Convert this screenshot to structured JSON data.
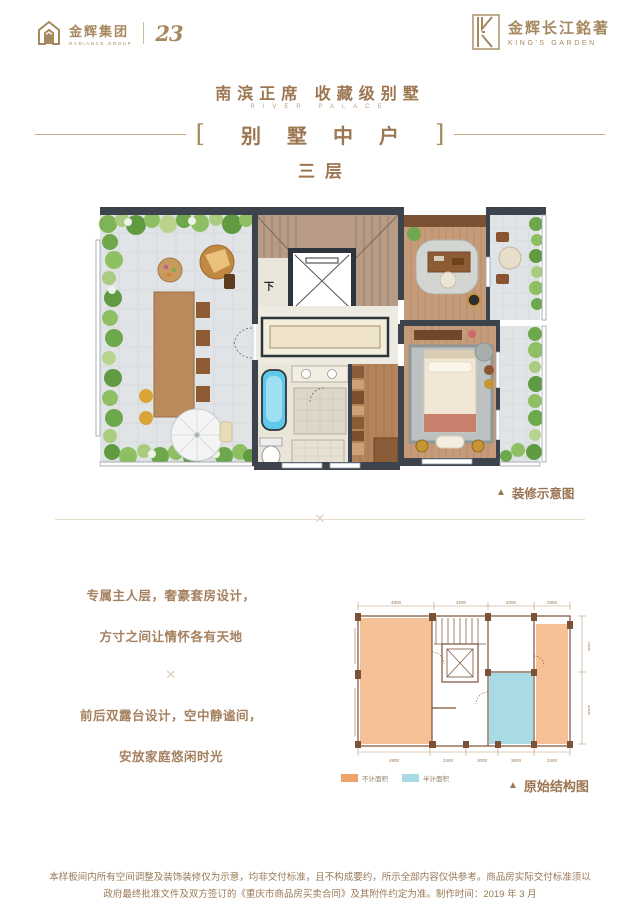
{
  "header": {
    "left_logo": {
      "name": "金辉集团",
      "tagline": "RADIANCE GROUP",
      "anniversary": "23"
    },
    "right_logo": {
      "name": "金辉长江銘著",
      "tagline": "KING'S GARDEN"
    },
    "title": "南滨正席 收藏级别墅",
    "title_en": "RIVER PALACE",
    "bracket_open": "[",
    "bracket_close": "]",
    "unit_label": "别墅中户",
    "floor_label": "三层"
  },
  "divider": {
    "ornament": "✕"
  },
  "plan": {
    "down_label": "下",
    "caption_marker": "▲",
    "caption": "装修示意图"
  },
  "copy": {
    "line1": "专属主人层，奢豪套房设计，",
    "line2": "方寸之间让情怀各有天地",
    "ornament": "✕",
    "line3": "前后双露台设计，空中静谧间，",
    "line4": "安放家庭悠闲时光"
  },
  "schematic": {
    "caption_marker": "▲",
    "caption": "原始结构图",
    "legend": [
      {
        "label": "不计面积",
        "color": "#f0a368"
      },
      {
        "label": "半计面积",
        "color": "#a9dbe5"
      }
    ],
    "dims_top": [
      "4800",
      "4200",
      "2000",
      "3300"
    ],
    "dims_bottom": [
      "4800",
      "2400",
      "3000",
      "3600",
      "2400"
    ],
    "dims_right": [
      "1800",
      "4500"
    ]
  },
  "footer": {
    "line1": "本样板间内所有空间调整及装饰装修仅为示意，均非交付标准，且不构成要约，所示全部内容仅供参考。商品房实际交付标准须以",
    "line2": "政府最终批准文件及双方签订的《重庆市商品房买卖合同》及其附件约定为准。制作时间：2019 年 3 月"
  },
  "colors": {
    "brand_gold": "#a6885f",
    "title_brown": "#9c7551",
    "wall_dark": "#3c434c",
    "copy_brown": "#a5805f",
    "terrace_orange": "#f0a368",
    "gift_blue": "#a9dbe5"
  }
}
